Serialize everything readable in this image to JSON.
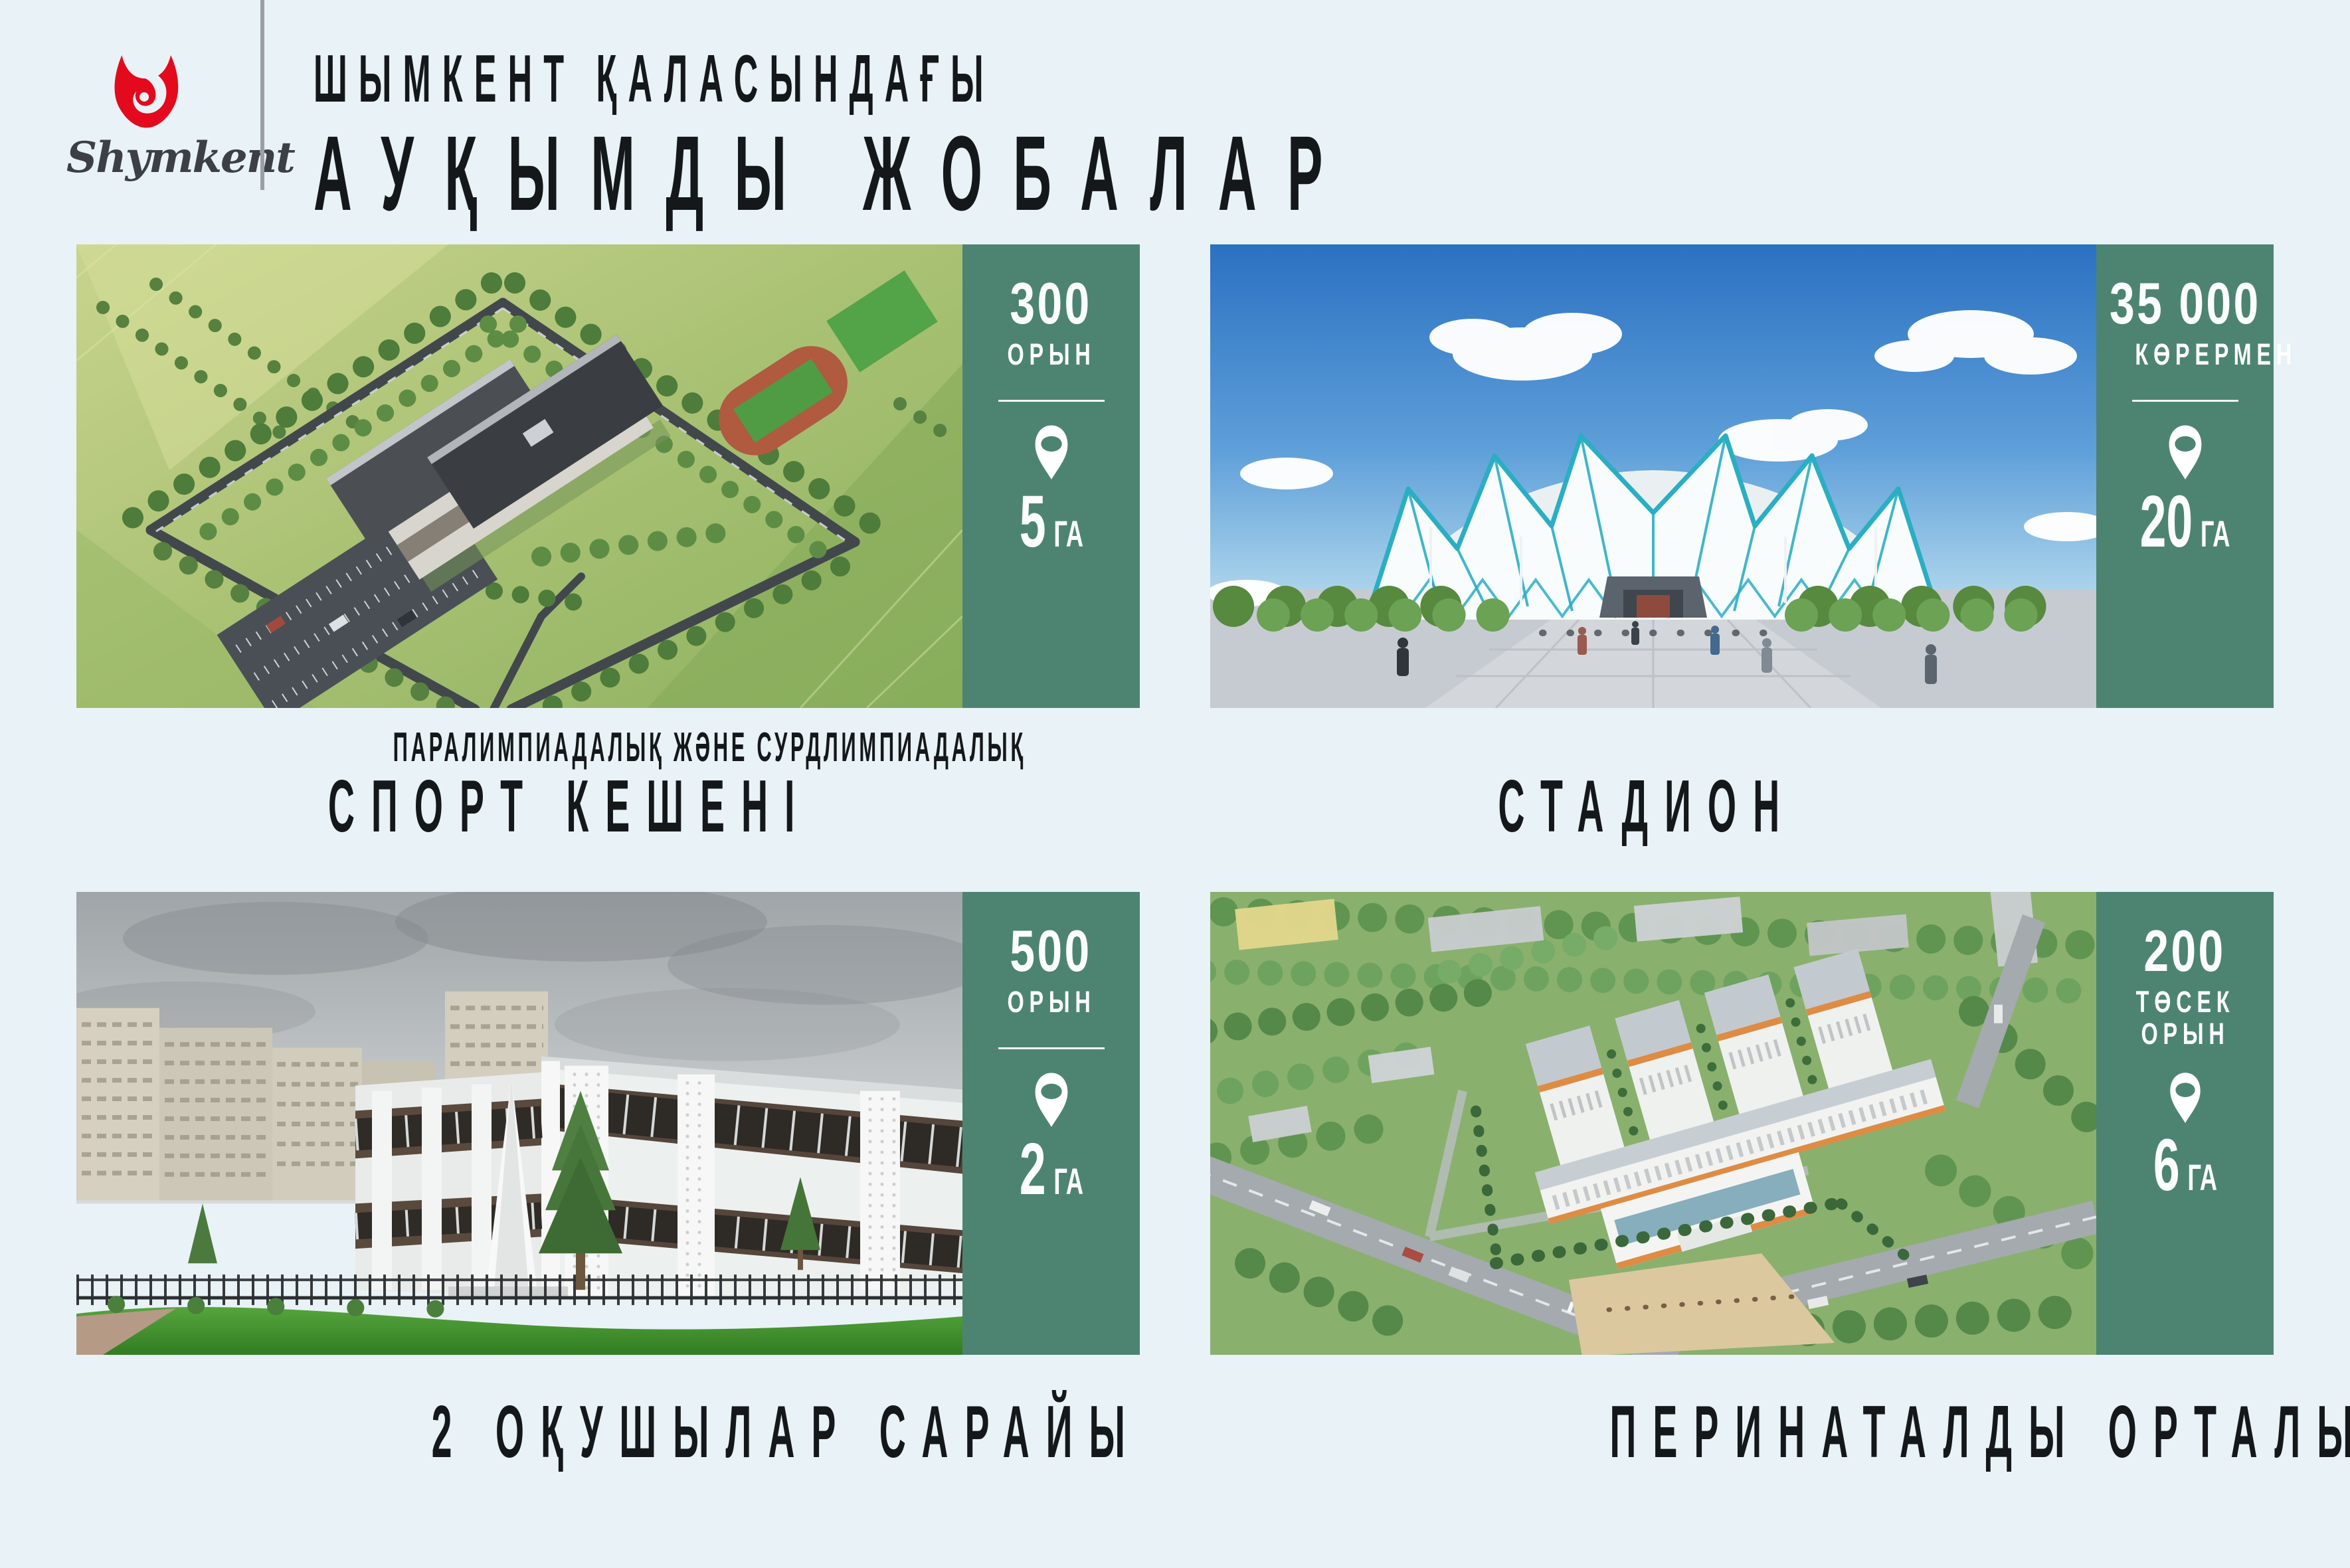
{
  "page": {
    "background": "#e9f2f6",
    "accent_green": "#4d8471",
    "text_color": "#15181b",
    "logo_red": "#e30a1d",
    "divider_gray": "#9ba0a4"
  },
  "header": {
    "logo_script": "Shymkent",
    "title_line1": "ШЫМКЕНТ ҚАЛАСЫНДАҒЫ",
    "title_line2": "АУҚЫМДЫ ЖОБАЛАР"
  },
  "cards": [
    {
      "name": "sport-complex",
      "stat_value": "300",
      "stat_label": "ОРЫН",
      "area_value": "5",
      "area_unit": "ГА",
      "caption_small": "ПАРАЛИМПИАДАЛЫҚ ЖӘНЕ СУРДЛИМПИАДАЛЫҚ",
      "caption_large": "СПОРТ КЕШЕНІ"
    },
    {
      "name": "stadium",
      "stat_value": "35 000",
      "stat_label": "КӨРЕРМЕН",
      "area_value": "20",
      "area_unit": "ГА",
      "caption_large": "СТАДИОН"
    },
    {
      "name": "school-palace",
      "stat_value": "500",
      "stat_label": "ОРЫН",
      "area_value": "2",
      "area_unit": "ГА",
      "caption_large": "2 ОҚУШЫЛАР САРАЙЫ"
    },
    {
      "name": "perinatal-center",
      "stat_value": "200",
      "stat_label": "ТӨСЕК ОРЫН",
      "area_value": "6",
      "area_unit": "ГА",
      "caption_large": "ПЕРИНАТАЛДЫ ОРТАЛЫҚ"
    }
  ],
  "icons": {
    "location_pin": "location-pin-icon",
    "tulip_logo": "tulip-logo-icon"
  }
}
